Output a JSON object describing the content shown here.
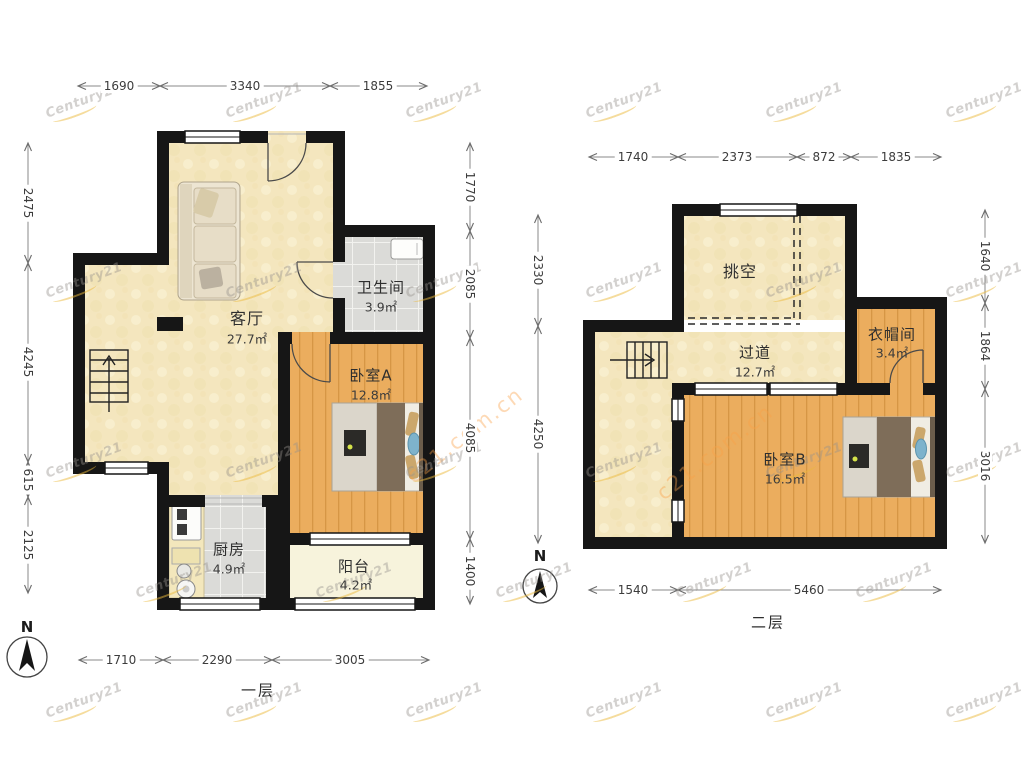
{
  "compass": {
    "label": "N"
  },
  "watermark": {
    "brand": "Century21",
    "site": "c21.com.cn"
  },
  "floor1": {
    "name": "一层",
    "rooms": {
      "living": {
        "label": "客厅",
        "area": "27.7㎡"
      },
      "bath": {
        "label": "卫生间",
        "area": "3.9㎡"
      },
      "bedroomA": {
        "label": "卧室A",
        "area": "12.8㎡"
      },
      "kitchen": {
        "label": "厨房",
        "area": "4.9㎡"
      },
      "balcony": {
        "label": "阳台",
        "area": "4.2㎡"
      }
    },
    "dims": {
      "top": [
        "1690",
        "3340",
        "1855"
      ],
      "left": [
        "2475",
        "4245",
        "615",
        "2125"
      ],
      "right": [
        "1770",
        "2085",
        "4085",
        "1400"
      ],
      "bottom": [
        "1710",
        "2290",
        "3005"
      ]
    }
  },
  "floor2": {
    "name": "二层",
    "rooms": {
      "void": {
        "label": "挑空",
        "area": ""
      },
      "hallway": {
        "label": "过道",
        "area": "12.7㎡"
      },
      "cloakroom": {
        "label": "衣帽间",
        "area": "3.4㎡"
      },
      "bedroomB": {
        "label": "卧室B",
        "area": "16.5㎡"
      }
    },
    "dims": {
      "top": [
        "1740",
        "2373",
        "872",
        "1835"
      ],
      "left": [
        "2330",
        "4250"
      ],
      "right": [
        "1640",
        "1864",
        "3016"
      ],
      "bottom": [
        "1540",
        "5460"
      ]
    }
  }
}
